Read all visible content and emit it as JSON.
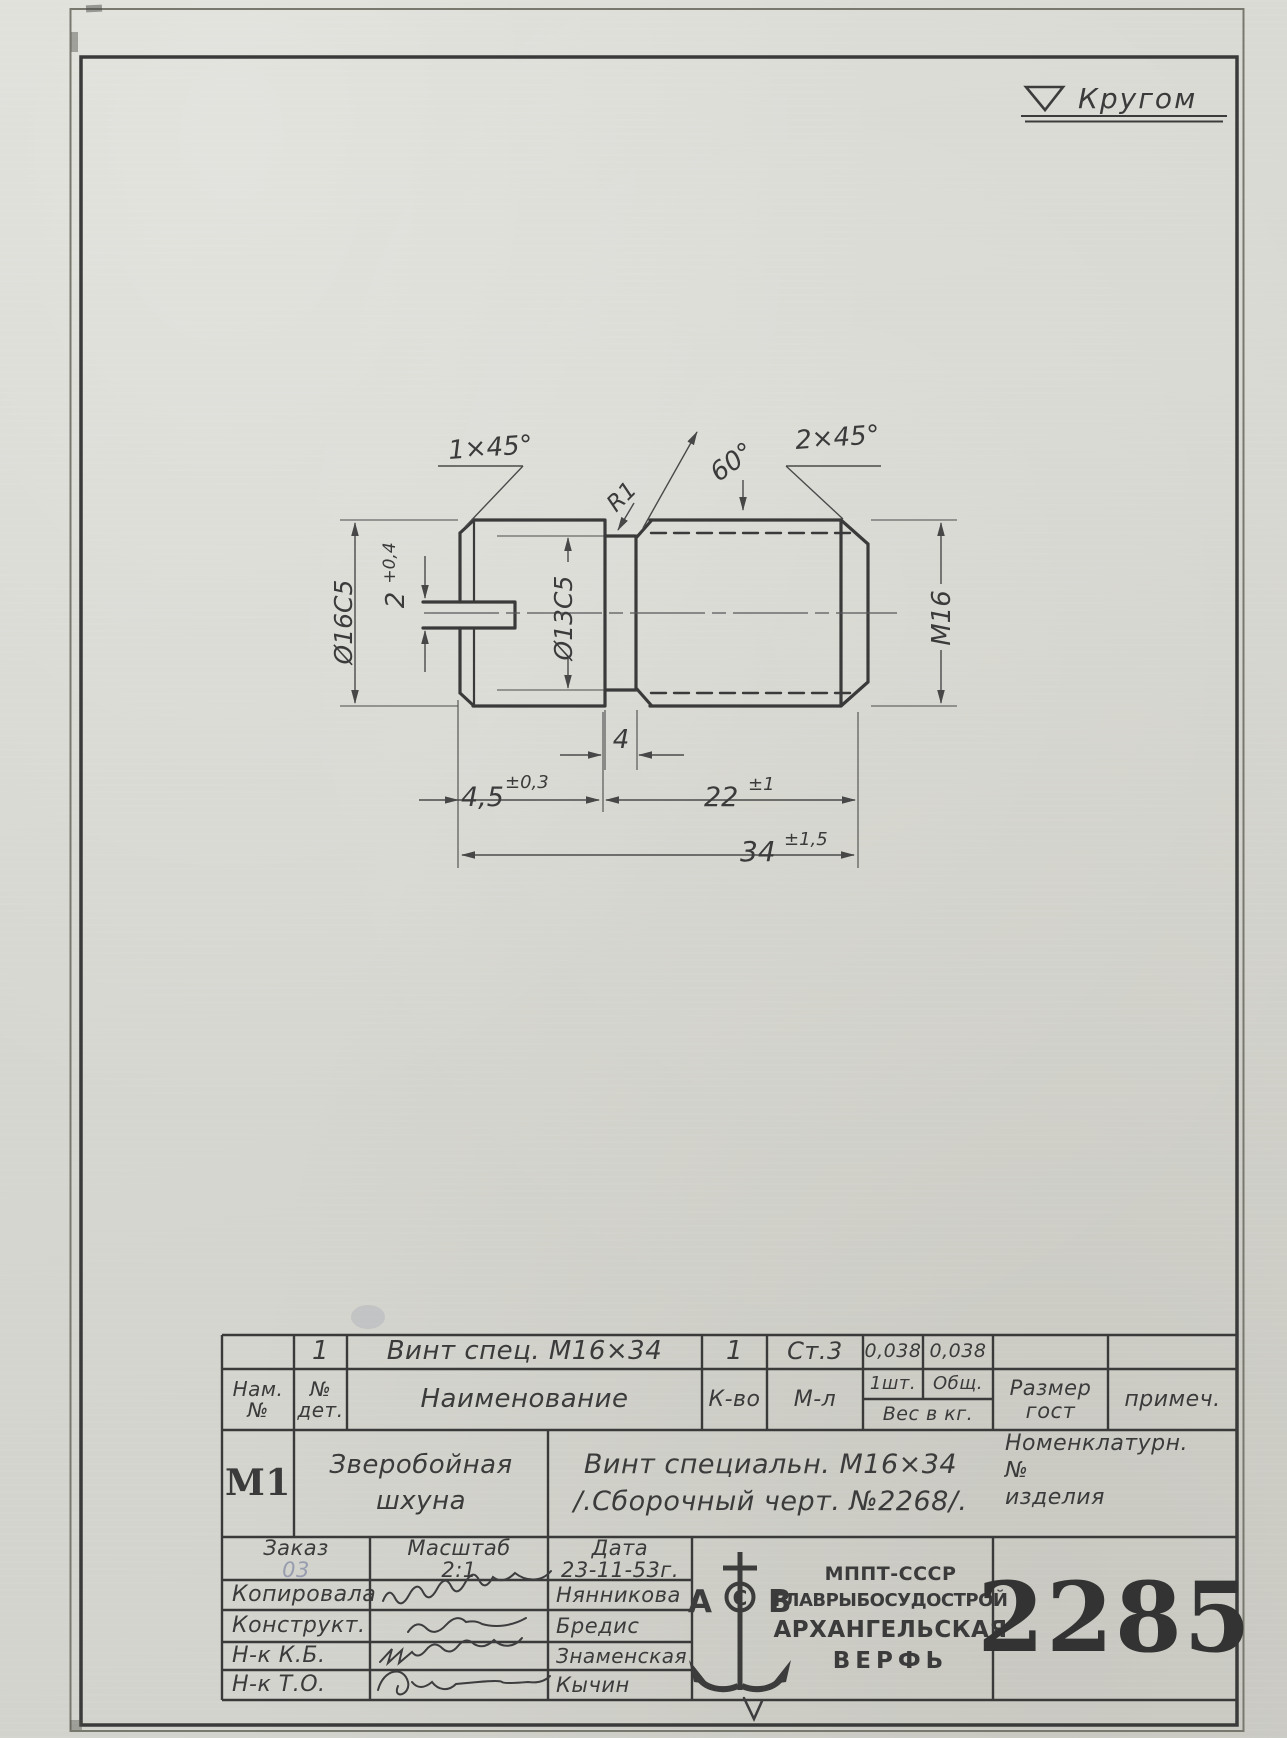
{
  "finish_mark": {
    "label": "Кругом"
  },
  "drawing_labels": {
    "chamfer_left": "1×45°",
    "fillet": "R1",
    "thread_angle": "60°",
    "chamfer_right": "2×45°",
    "head_diameter": "Ø16С5",
    "slot_width": "2",
    "slot_width_tol": "+0,4",
    "neck_diameter": "Ø13С5",
    "thread": "М16",
    "neck_length": "4",
    "head_length": "4,5",
    "head_length_tol": "±0,3",
    "thread_length": "22",
    "thread_length_tol": "±1",
    "overall_length": "34",
    "overall_length_tol": "±1,5"
  },
  "parts_table": {
    "row": {
      "det_no": "1",
      "name": "Винт спец. М16×34",
      "qty": "1",
      "material": "Ст.3",
      "weight_each": "0,038",
      "weight_total": "0,038"
    },
    "header": {
      "nom1": "Нам.",
      "nom2": "№",
      "det1": "№",
      "det2": "дет.",
      "name": "Наименование",
      "qty": "К-во",
      "material": "М-л",
      "w_each": "1шт.",
      "w_total": "Общ.",
      "w_unit": "Вес в кг.",
      "size1": "Размер",
      "size2": "гост",
      "note": "примеч."
    }
  },
  "title_block": {
    "code": "М1",
    "object_line1": "Зверобойная",
    "object_line2": "шхуна",
    "name_line1": "Винт специальн. М16×34",
    "name_line2": "/.Сборочный черт. №2268/.",
    "nomen_line1": "Номенклатурн.",
    "nomen_line2": "№",
    "nomen_line3": "изделия"
  },
  "staff": {
    "order_label": "Заказ",
    "order_value": "03",
    "scale_label": "Масштаб",
    "scale_value": "2:1",
    "date_label": "Дата",
    "date_value": "23-11-53г.",
    "rows": [
      {
        "role": "Копировала",
        "name": "Нянникова"
      },
      {
        "role": "Конструкт.",
        "name": "Бредис"
      },
      {
        "role": "Н-к К.Б.",
        "name": "Знаменская"
      },
      {
        "role": "Н-к Т.О.",
        "name": "Кычин"
      }
    ]
  },
  "org": {
    "line1": "МППТ-СССР",
    "line2": "ГЛАВРЫБОСУДОСТРОЙ",
    "line3": "АРХАНГЕЛЬСКАЯ",
    "line4": "ВЕРФЬ",
    "logo_a": "А",
    "logo_c": "С",
    "logo_b": "В"
  },
  "drawing_number": "2285"
}
